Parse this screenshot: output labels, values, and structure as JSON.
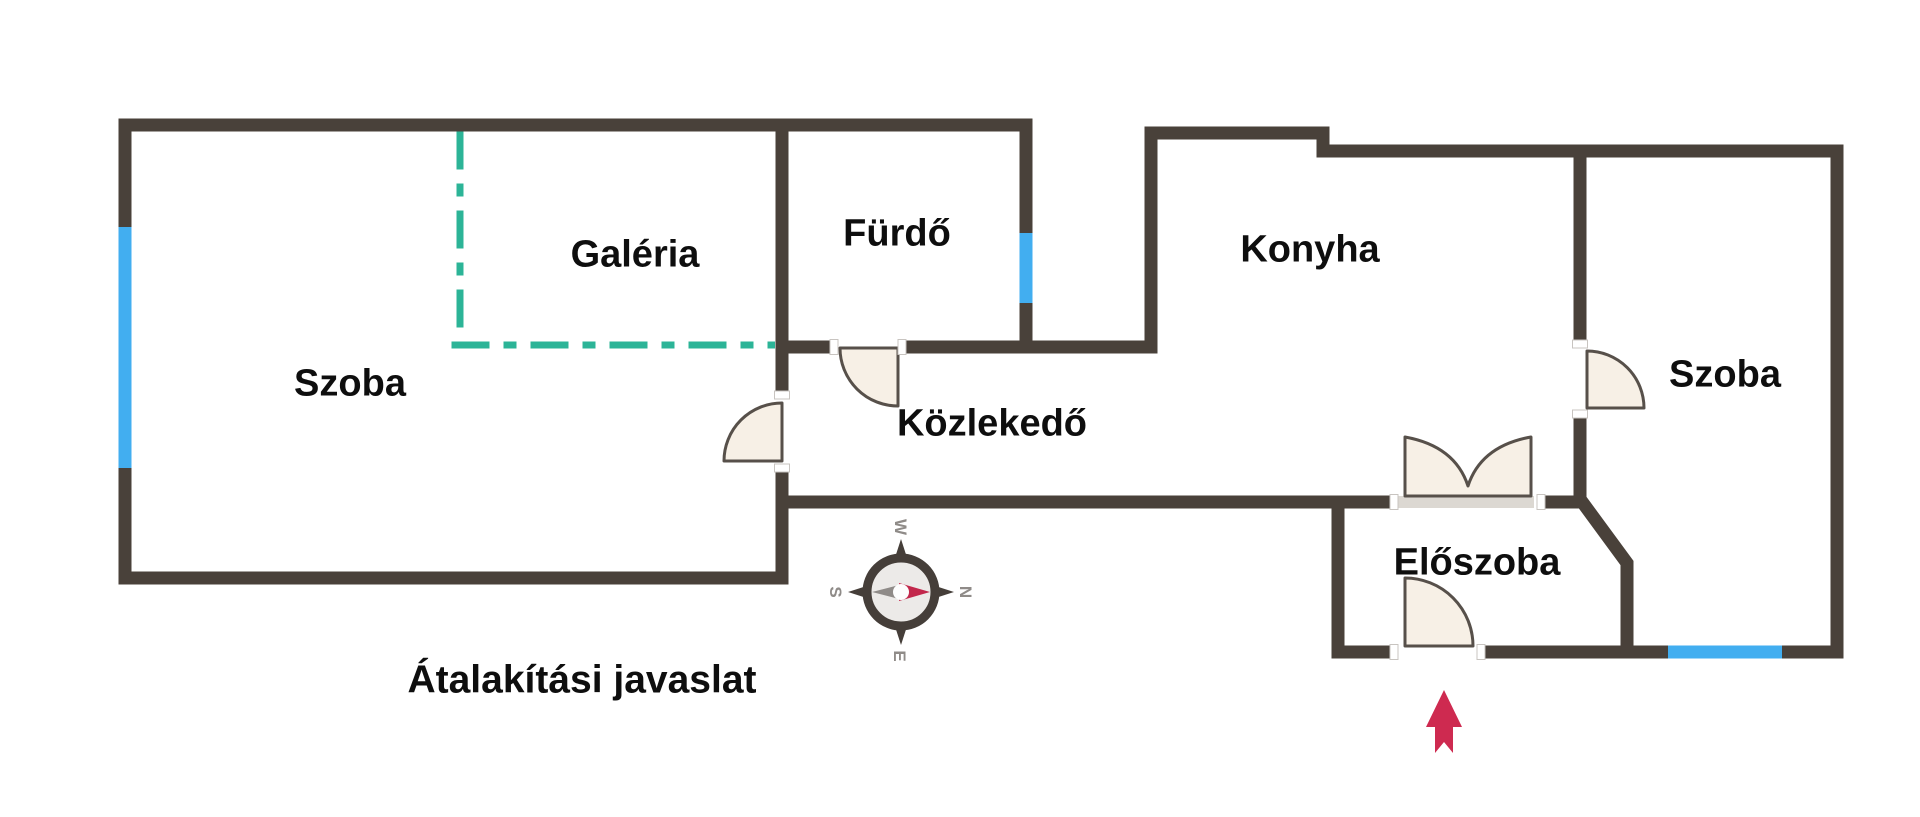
{
  "title": {
    "text": "Átalakítási javaslat"
  },
  "rooms": {
    "szoba_left": {
      "label": "Szoba"
    },
    "galeria": {
      "label": "Galéria"
    },
    "furdo": {
      "label": "Fürdő"
    },
    "konyha": {
      "label": "Konyha"
    },
    "kozlekedo": {
      "label": "Közlekedő"
    },
    "szoba_right": {
      "label": "Szoba"
    },
    "eloszoba": {
      "label": "Előszoba"
    }
  },
  "compass": {
    "letters": {
      "top": "W",
      "right": "N",
      "bottom": "E",
      "left": "S"
    },
    "needle_points_to": "N"
  },
  "features": {
    "windows": [
      "left-wall-window",
      "bathroom-lightwell-window",
      "bottom-right-window"
    ],
    "doors": [
      "szoba-left-door",
      "bathroom-door",
      "szoba-right-door",
      "double-door-hall",
      "entrance-door"
    ],
    "gallery_marking": "dash-dot-outline",
    "entrance_marker": "red-arrow-up"
  },
  "colors": {
    "wall": "#49413a",
    "window": "#42aef0",
    "gallery_dashed": "#2cb497",
    "door_fill": "#f7f0e6",
    "door_stroke": "#57504a",
    "entrance_arrow": "#ce2a50",
    "label": "#0e0e0e",
    "compass_letter": "#8f8b88",
    "background": "#ffffff"
  }
}
